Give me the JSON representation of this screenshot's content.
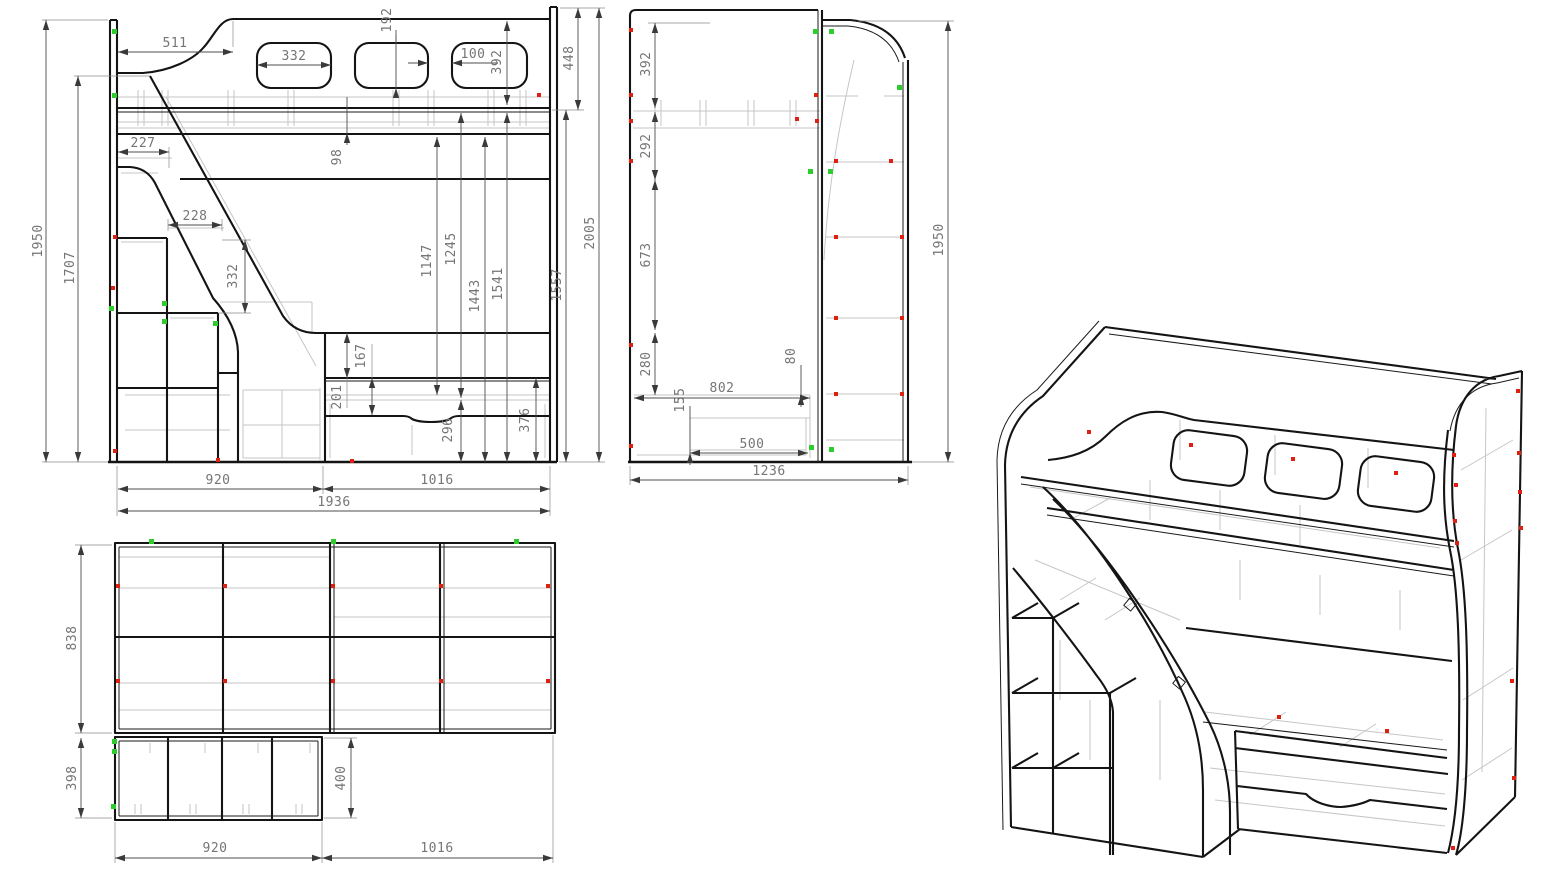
{
  "colors": {
    "background": "#ffffff",
    "outline": "#141414",
    "hidden_line": "#c6c6c6",
    "dimension_line": "#4d4d4d",
    "dimension_text": "#757575",
    "fastener_red": "#dd2010",
    "fastener_green": "#2ecc2e"
  },
  "views": {
    "front": {
      "dims": {
        "h1950": "1950",
        "h1707": "1707",
        "w511": "511",
        "w332": "332",
        "h192": "192",
        "w100": "100",
        "h392": "392",
        "h448": "448",
        "h98": "98",
        "w227": "227",
        "w228": "228",
        "h332": "332",
        "h1147": "1147",
        "h1245": "1245",
        "h1443": "1443",
        "h1541": "1541",
        "h1557": "1557",
        "h2005": "2005",
        "h167": "167",
        "h201": "201",
        "h296": "296",
        "h376": "376",
        "w920": "920",
        "w1016": "1016",
        "w1936": "1936"
      }
    },
    "side": {
      "dims": {
        "h392": "392",
        "h292": "292",
        "h673": "673",
        "h280": "280",
        "h155": "155",
        "w802": "802",
        "h80": "80",
        "w500": "500",
        "w1236": "1236",
        "h1950": "1950"
      }
    },
    "top": {
      "dims": {
        "d838": "838",
        "d398": "398",
        "d400": "400",
        "w920": "920",
        "w1016": "1016"
      }
    }
  }
}
